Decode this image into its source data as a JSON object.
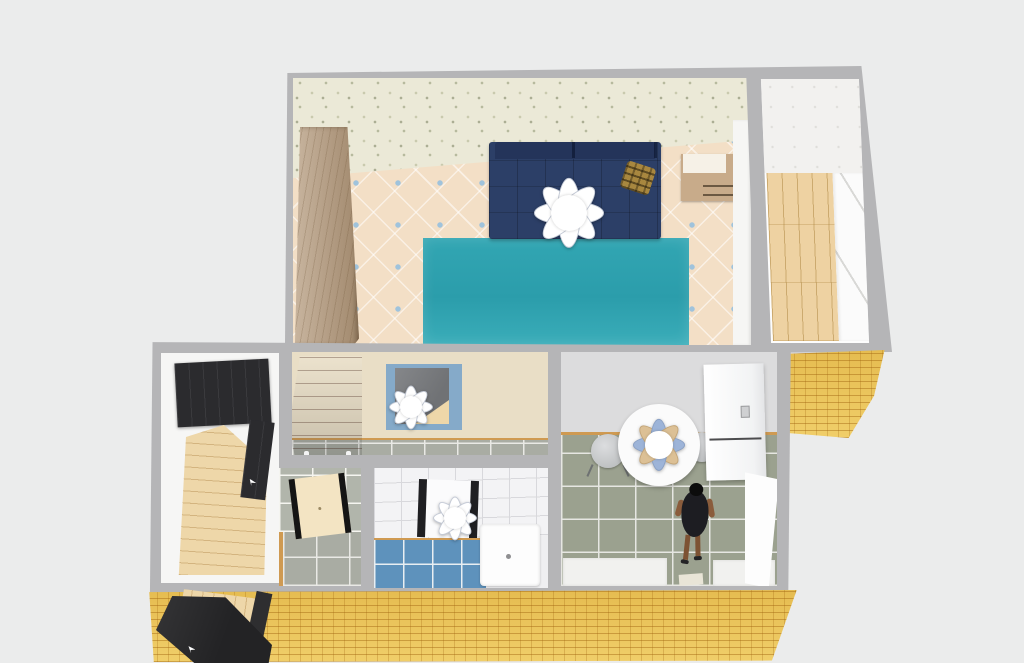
{
  "scene": {
    "title": "3D floor plan render — one-room apartment, top-down view",
    "style": "isometric 3D render, no visible text or UI chrome"
  },
  "labels": {
    "plan": "3D floor plan of a one-room apartment",
    "living_room": "Living room / bedroom with floral wallpaper and beige tiled floor",
    "balcony": "Balcony with wood floor and window sills",
    "hallway": "Entrance hall with wood floor",
    "corridor": "Corridor with cabinet and open doorway",
    "toilet": "Toilet room with grey tiled floor",
    "bathroom": "Bathroom with blue tiled floor",
    "kitchen": "Kitchen with grey tiled floor",
    "wardrobe": "Wooden wardrobe",
    "sofa": "Navy blue sofa",
    "pillow": "Patterned cushion",
    "rug": "Teal rug",
    "nightstand": "Wooden nightstand",
    "ceiling_light": "Ceiling light (flower chandelier)",
    "window_sill": "Window sill / radiator panel",
    "hall_wardrobe": "Dark hallway wardrobe",
    "hall_door": "Dark interior door",
    "hall_floor": "Light wood hallway floor",
    "cabinet": "Mahogany corridor cabinet",
    "doorway": "Blue-framed open doorway",
    "toilet_door": "Open toilet door",
    "mirror": "Dark-framed bathroom mirror",
    "washer": "Washing machine",
    "dining_table": "Round white dining table",
    "chair": "Kitchen chair",
    "fridge": "Refrigerator",
    "person": "Person standing in kitchen",
    "counter": "White kitchen counter strip",
    "mat": "Small floor mat",
    "front_door": "Open front door",
    "brick_wall": "Yellow brick exterior wall",
    "balcony_floor": "Balcony wood floor",
    "balcony_wall": "Balcony white wall"
  },
  "counts": {
    "ceiling_lights": 4,
    "rooms": 7
  },
  "colors": {
    "background": "#ebecec",
    "wall": "#b5b5b7",
    "wallpaper": "#ebe9d7",
    "wallpaper_speck": "#b4b79b",
    "tile_floor": "#f3dfc6",
    "tile_dot": "#9fc3dc",
    "rug": "#32a6b3",
    "sofa": "#2c3f67",
    "sofa_dark": "#24345a",
    "pillow": "#a8873f",
    "wardrobe": "#b59b7e",
    "nightstand": "#c8ab8a",
    "balcony_wall": "#f2f1ef",
    "balcony_floor": "#eed2a2",
    "brick": "#ebc457",
    "hall_floor": "#eed7a9",
    "dark_furniture": "#2b2b2e",
    "corridor_wall": "#e9dec6",
    "cabinet": "#93441e",
    "frame_blue": "#85aac9",
    "gray_tile": "#a9aca3",
    "grout": "#e9e9e5",
    "toilet_door": "#f3e4c3",
    "bath_tile": "#f3f3f5",
    "bath_grout": "#d8d8dc",
    "blue_tile": "#5e92bc",
    "washer": "#fdfdfd",
    "kitchen_wall": "#dcdcdd",
    "kitchen_floor": "#9ba18f",
    "baseboard": "#cf9a52",
    "table": "#fbfbfb",
    "petal_blue": "#9db4d8",
    "petal_tan": "#dcc095",
    "chair": "#b4b7b8",
    "person_dress": "#1d1d22",
    "person_skin": "#8a5c3c",
    "flower_white": "#ffffff",
    "flower_edge": "#c4cad6"
  }
}
